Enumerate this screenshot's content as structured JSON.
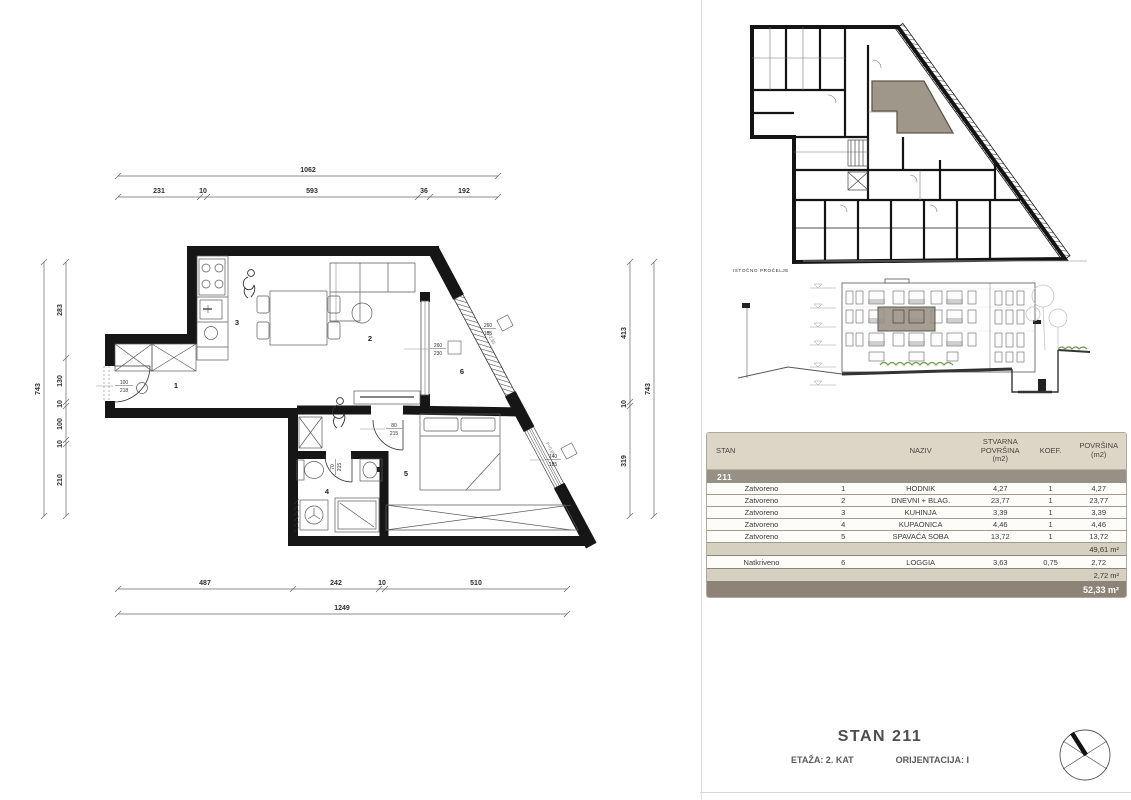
{
  "floor_plan": {
    "rooms": {
      "n1": "1",
      "n2": "2",
      "n3": "3",
      "n4": "4",
      "n5": "5",
      "n6": "6"
    },
    "openings": {
      "entrance_w": "100",
      "entrance_h": "218",
      "bedroom_door_w": "80",
      "bedroom_door_h": "215",
      "bath_door_w": "70",
      "bath_door_h": "215",
      "loggia_glass_w": "260",
      "loggia_glass_h": "230",
      "loggia_rail_w": "260",
      "loggia_rail_h": "185",
      "bedroom_win_w": "140",
      "bedroom_win_h": "185",
      "parapet_loggia": "P=2,85",
      "parapet_bedroom": "P=0,85"
    },
    "dims": {
      "top_total": "1062",
      "top": [
        "231",
        "10",
        "593",
        "36",
        "192"
      ],
      "bottom": [
        "487",
        "242",
        "10",
        "510"
      ],
      "bottom_total": "1249",
      "left": [
        "283",
        "130",
        "10",
        "100",
        "10",
        "210"
      ],
      "left_total": "743",
      "right": [
        "413",
        "10",
        "319"
      ],
      "right_total": "743"
    }
  },
  "elevation": {
    "label": "ISTOČNO PROČELJE"
  },
  "area_table": {
    "headers": {
      "stan": "STAN",
      "naziv": "NAZIV",
      "stvarna": "STVARNA\nPOVRŠINA\n(m2)",
      "koef": "KOEF.",
      "povrsina": "POVRŠINA\n(m2)"
    },
    "unit": "211",
    "rows": [
      {
        "type": "Zatvoreno",
        "num": "1",
        "name": "HODNIK",
        "actual": "4,27",
        "coef": "1",
        "area": "4,27"
      },
      {
        "type": "Zatvoreno",
        "num": "2",
        "name": "DNEVNI + BLAG.",
        "actual": "23,77",
        "coef": "1",
        "area": "23,77"
      },
      {
        "type": "Zatvoreno",
        "num": "3",
        "name": "KUHINJA",
        "actual": "3,39",
        "coef": "1",
        "area": "3,39"
      },
      {
        "type": "Zatvoreno",
        "num": "4",
        "name": "KUPAONICA",
        "actual": "4,46",
        "coef": "1",
        "area": "4,46"
      },
      {
        "type": "Zatvoreno",
        "num": "5",
        "name": "SPAVAĆA SOBA",
        "actual": "13,72",
        "coef": "1",
        "area": "13,72"
      }
    ],
    "closed_subtotal": "49,61 m²",
    "covered_row": {
      "type": "Natkriveno",
      "num": "6",
      "name": "LOGGIA",
      "actual": "3,63",
      "coef": "0,75",
      "area": "2,72"
    },
    "covered_subtotal": "2,72 m²",
    "total": "52,33 m²"
  },
  "title_block": {
    "title": "STAN 211",
    "floor": "ETAŽA: 2. KAT",
    "orientation": "ORIJENTACIJA: I"
  },
  "colors": {
    "highlight": "#9a9184",
    "highlight_border": "#60574c",
    "table_header": "#dcd6c7",
    "unit_band": "#969085",
    "subtotal_band": "#d6d0c1",
    "total_band": "#8d8376",
    "hedge_green": "#6f9a4f"
  }
}
